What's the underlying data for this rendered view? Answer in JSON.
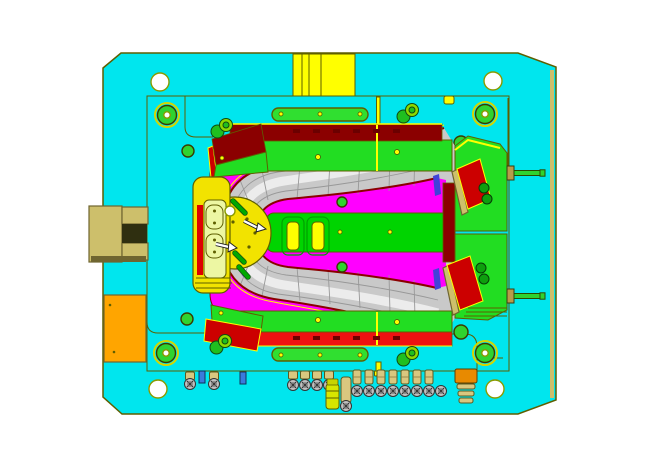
{
  "window": {
    "background": "#FFFFFF",
    "view_type": "mold-base-top-view-cad"
  },
  "palette": {
    "plate": "#00E6EE",
    "edge": "#5E5F00",
    "yellow": "#FFFF00",
    "magenta": "#FF00FF",
    "maroon": "#8B0000",
    "maroonDark": "#6B0000",
    "brightRed": "#EE1111",
    "insertRed": "#CC0000",
    "green": "#22DD22",
    "islandGreen": "#00D400",
    "pillGreen": "#30DF30",
    "darkGreenHole": "#0E9E0E",
    "pinGreen": "#2FD32F",
    "dowelGreen": "#1FBF1F",
    "dowelLight": "#8FD900",
    "grayFill": "#C9C9C9",
    "grayEdge": "#989898",
    "highlight": "#EEEEEE",
    "bossYellow": "#F2E300",
    "paleSlot": "#EDF7A3",
    "khaki": "#CDBF6B",
    "khakiDark": "#6F6530",
    "tan": "#D9C77F",
    "tanDark": "#B89B4A",
    "orange": "#FFA500",
    "orangeDeep": "#E88A00",
    "blue": "#3A7ADC",
    "blueInsert": "#4242D8",
    "white": "#FFFFFF",
    "screwGray": "#C0C0C0",
    "ejectorPin": "#00A800"
  },
  "components": {
    "plate": "mold base plate",
    "sprue": "sprue / locating block",
    "pocket": "cavity pocket",
    "stripper": "stripper ring (magenta)",
    "part_surface": "molded part swept surface",
    "core_island": "core island",
    "ejector_boss": "ejector boss",
    "slide_top": "top slide band",
    "slide_bottom": "bottom slide band",
    "wedge_top_left": "angled wedge block",
    "wedge_bottom_left": "angled wedge block",
    "block_top_right": "slide block with red insert",
    "block_bottom_right": "slide block with red insert",
    "clamp_bracket": "clamp bracket",
    "support_block": "support block",
    "side_pins": "return pins",
    "hardware": "fasteners row"
  },
  "hardware_counts": {
    "guide_pins": 4,
    "corner_holes": 4,
    "small_green_holes": 4,
    "dowel_pairs": 4,
    "screw_heads": 15,
    "screw_caps": 6,
    "pin_cylinders": 7,
    "blue_clips": 2,
    "side_pins": 2,
    "slot_pair_core": 2,
    "boss_slots": 2
  }
}
